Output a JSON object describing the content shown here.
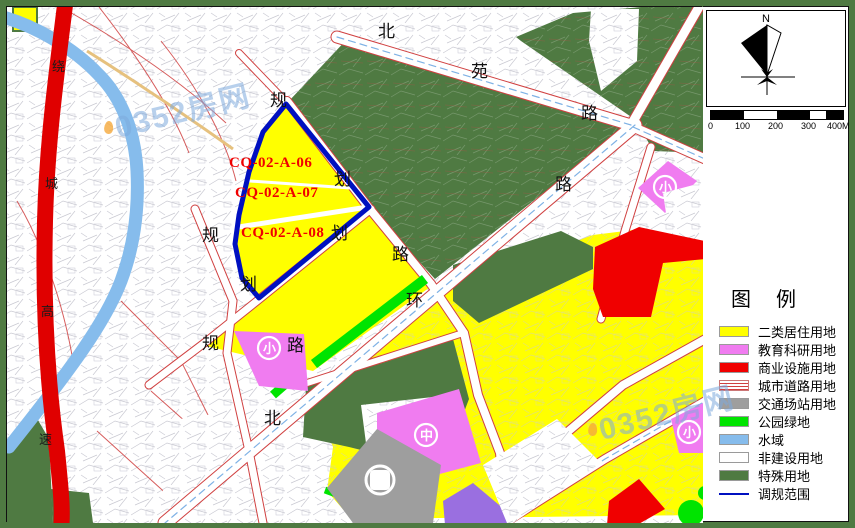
{
  "colors": {
    "residential_yellow": "#FFFF00",
    "education_pink": "#F07CF0",
    "commercial_red": "#F00000",
    "transport_gray": "#9E9E9E",
    "park_green": "#00E400",
    "water_blue": "#86BCEC",
    "special_dark_green": "#4F7A42",
    "non_construction_white": "#FFFFFF",
    "scope_blue": "#0010C0",
    "expressway_red": "#E00000",
    "purple_parcel": "#9A6FE0"
  },
  "map": {
    "parcel_codes": [
      "CQ-02-A-06",
      "CQ-02-A-07",
      "CQ-02-A-08"
    ],
    "road_chars": [
      "北",
      "苑",
      "路",
      "路",
      "环",
      "北",
      "规",
      "划",
      "路",
      "规",
      "划",
      "划",
      "规",
      "路"
    ],
    "expressway_chars": [
      "绕",
      "城",
      "高",
      "速"
    ],
    "school_symbols": [
      "小",
      "中",
      "小",
      "小"
    ]
  },
  "watermark": {
    "text": "0352房网"
  },
  "panel": {
    "north_label": "N",
    "scale_ticks": [
      "0",
      "100",
      "200",
      "300",
      "400M"
    ],
    "legend_title": "图 例",
    "legend": {
      "items": [
        {
          "label": "二类居住用地",
          "color": "#FFFF00",
          "type": "solid"
        },
        {
          "label": "教育科研用地",
          "color": "#F07CF0",
          "type": "solid"
        },
        {
          "label": "商业设施用地",
          "color": "#F00000",
          "type": "solid"
        },
        {
          "label": "城市道路用地",
          "color": null,
          "type": "road"
        },
        {
          "label": "交通场站用地",
          "color": "#9E9E9E",
          "type": "solid"
        },
        {
          "label": "公园绿地",
          "color": "#00E400",
          "type": "solid"
        },
        {
          "label": "水域",
          "color": "#86BCEC",
          "type": "solid"
        },
        {
          "label": "非建设用地",
          "color": "#FFFFFF",
          "type": "solid"
        },
        {
          "label": "特殊用地",
          "color": "#4F7A42",
          "type": "solid"
        },
        {
          "label": "调规范围",
          "color": null,
          "type": "scope"
        }
      ]
    }
  }
}
